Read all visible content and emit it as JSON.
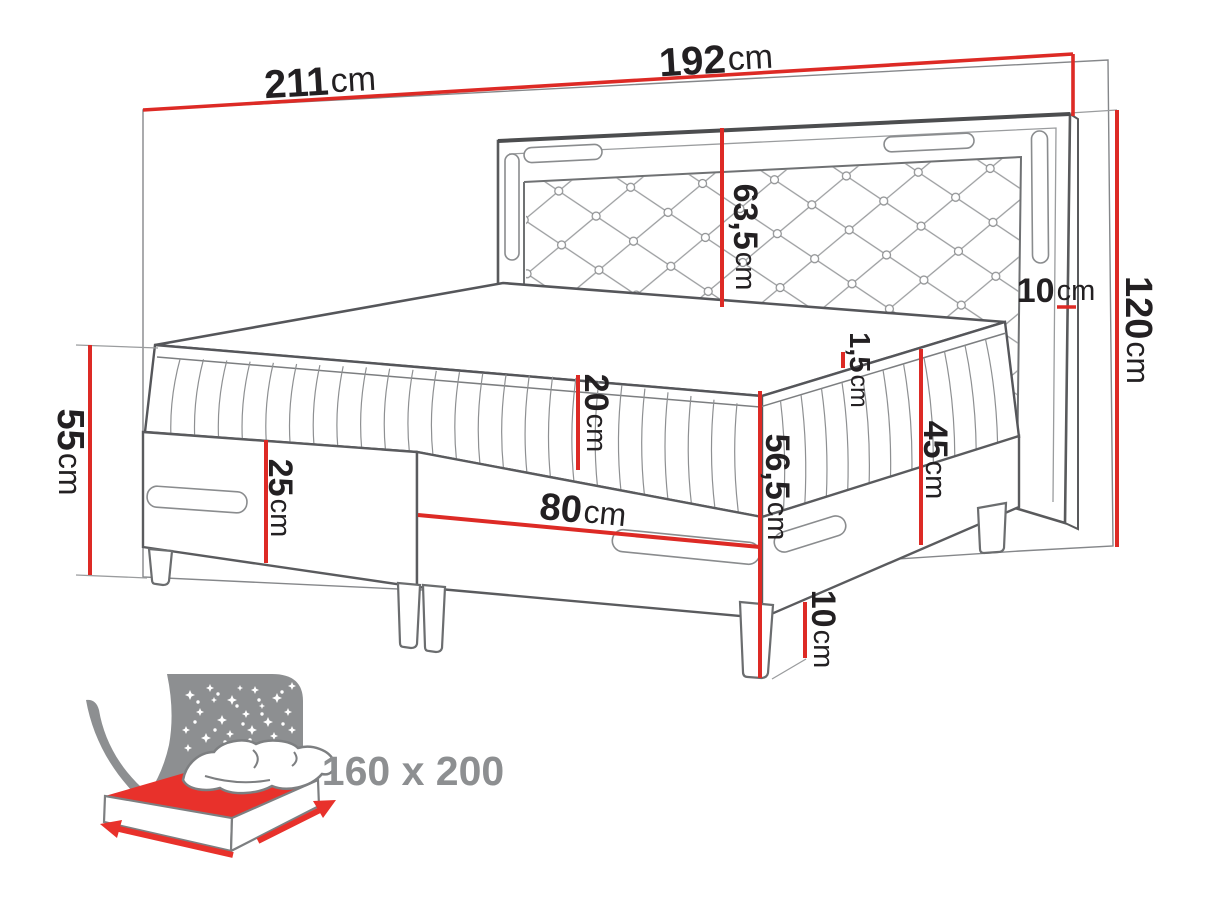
{
  "diagram": {
    "type": "bed-dimension-drawing",
    "size_label": "160 x 200"
  },
  "colors": {
    "dimension_red": "#dd2a25",
    "outline_dark": "#55565a",
    "outline_light": "#909294",
    "text_black": "#232022",
    "icon_gray": "#8d8f91",
    "icon_red": "#e8312b"
  },
  "dimensions": {
    "wall_width": {
      "value": "211",
      "unit": "cm"
    },
    "headboard_width": {
      "value": "192",
      "unit": "cm"
    },
    "headboard_panel_height": {
      "value": "63,5",
      "unit": "cm"
    },
    "headboard_frame_width": {
      "value": "10",
      "unit": "cm"
    },
    "headboard_height": {
      "value": "120",
      "unit": "cm"
    },
    "side_height": {
      "value": "55",
      "unit": "cm"
    },
    "mattress_height": {
      "value": "20",
      "unit": "cm"
    },
    "box_height": {
      "value": "25",
      "unit": "cm"
    },
    "single_box_width": {
      "value": "80",
      "unit": "cm"
    },
    "topper_height": {
      "value": "1,5",
      "unit": "cm"
    },
    "mattress_top_height": {
      "value": "56,5",
      "unit": "cm"
    },
    "base_top_height": {
      "value": "45",
      "unit": "cm"
    },
    "leg_height": {
      "value": "10",
      "unit": "cm"
    }
  }
}
